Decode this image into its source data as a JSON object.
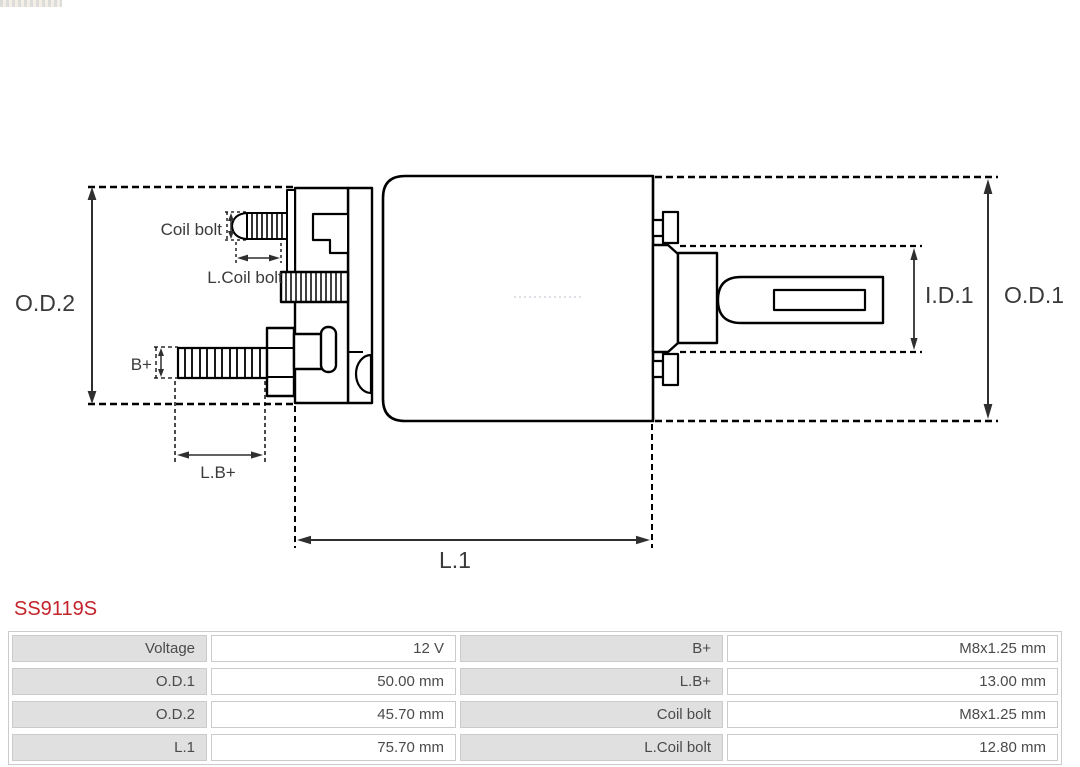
{
  "colors": {
    "accent": "#c4232a",
    "table-label-bg": "#e0e0e0",
    "table-border": "#cbcbcb",
    "table-text": "#4a4a4a",
    "line": "#000000",
    "diagram-label": "#3a3a3a"
  },
  "product": {
    "code": "SS9119S"
  },
  "diagram": {
    "labels": {
      "od2": "O.D.2",
      "od1": "O.D.1",
      "id1": "I.D.1",
      "l1": "L.1",
      "coil_bolt": "Coil bolt",
      "l_coil_bolt": "L.Coil bolt",
      "b_plus": "B+",
      "lb_plus": "L.B+"
    }
  },
  "spec_table": {
    "rows": [
      {
        "label1": "Voltage",
        "value1": "12 V",
        "label2": "B+",
        "value2": "M8x1.25 mm"
      },
      {
        "label1": "O.D.1",
        "value1": "50.00 mm",
        "label2": "L.B+",
        "value2": "13.00 mm"
      },
      {
        "label1": "O.D.2",
        "value1": "45.70 mm",
        "label2": "Coil bolt",
        "value2": "M8x1.25 mm"
      },
      {
        "label1": "L.1",
        "value1": "75.70 mm",
        "label2": "L.Coil bolt",
        "value2": "12.80 mm"
      }
    ]
  }
}
